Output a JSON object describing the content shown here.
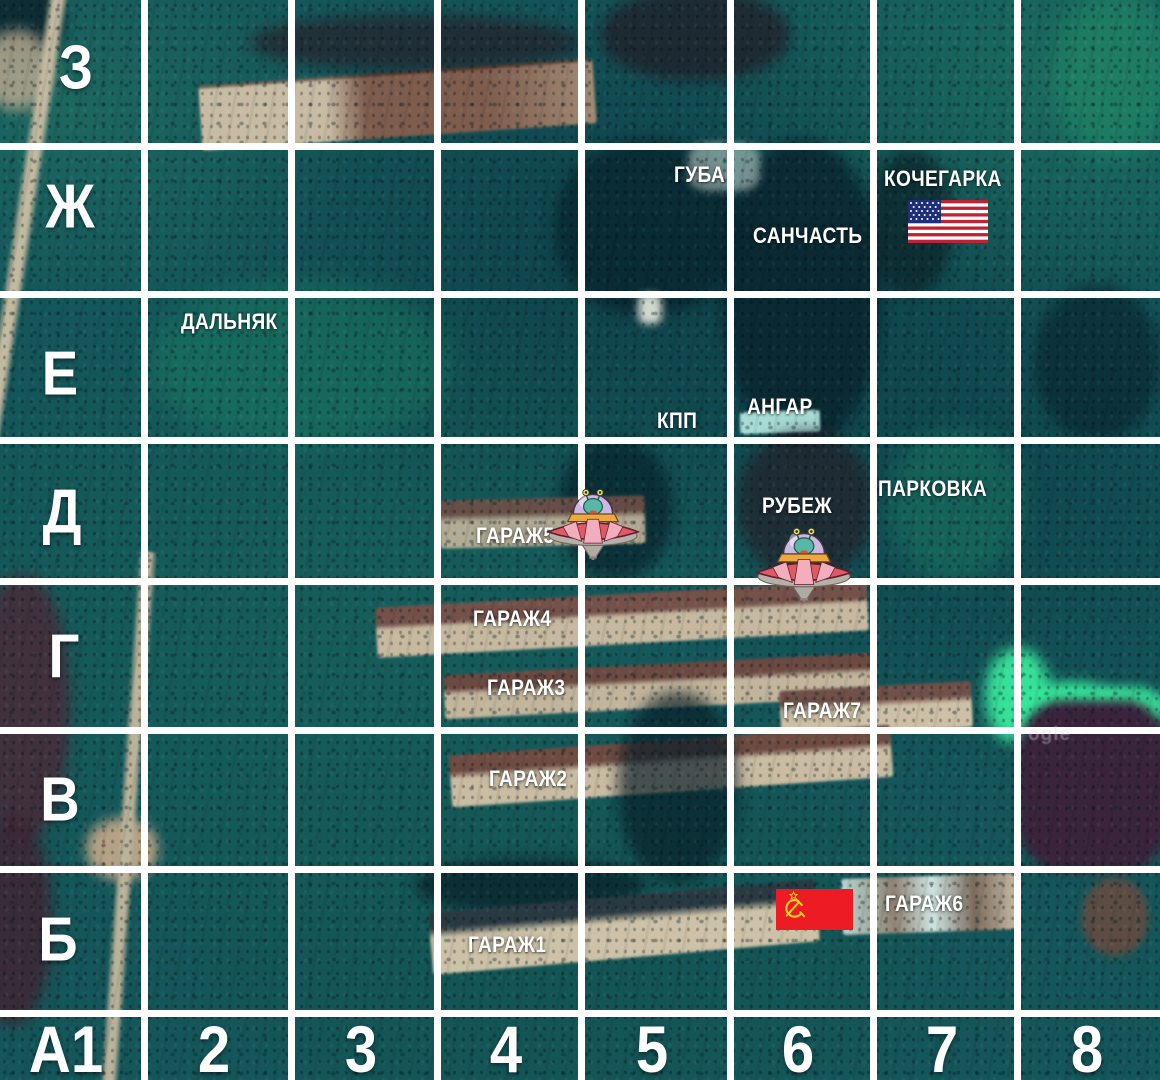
{
  "grid": {
    "rows": [
      "З",
      "Ж",
      "Е",
      "Д",
      "Г",
      "В",
      "Б"
    ],
    "corner": "А1",
    "columns": [
      "2",
      "3",
      "4",
      "5",
      "6",
      "7",
      "8"
    ]
  },
  "locations": [
    {
      "label": "ГУБА",
      "cell": "Ж5"
    },
    {
      "label": "КОЧЕГАРКА",
      "cell": "Ж7"
    },
    {
      "label": "САНЧАСТЬ",
      "cell": "Ж6"
    },
    {
      "label": "ДАЛЬНЯК",
      "cell": "Е2"
    },
    {
      "label": "КПП",
      "cell": "Е5"
    },
    {
      "label": "АНГАР",
      "cell": "Е6"
    },
    {
      "label": "ГАРАЖ5",
      "cell": "Д4"
    },
    {
      "label": "РУБЕЖ",
      "cell": "Д6"
    },
    {
      "label": "ПАРКОВКА",
      "cell": "Д7"
    },
    {
      "label": "ГАРАЖ4",
      "cell": "Г4"
    },
    {
      "label": "ГАРАЖ3",
      "cell": "Г4"
    },
    {
      "label": "ГАРАЖ7",
      "cell": "Г6"
    },
    {
      "label": "ГАРАЖ2",
      "cell": "В4"
    },
    {
      "label": "ГАРАЖ1",
      "cell": "Б4"
    },
    {
      "label": "ГАРАЖ6",
      "cell": "Б7"
    }
  ],
  "markers": [
    {
      "name": "us-flag",
      "cell": "Ж7"
    },
    {
      "name": "soviet-flag",
      "cell": "Б6"
    },
    {
      "name": "ufo",
      "cell": "Д4/Д5"
    },
    {
      "name": "ufo",
      "cell": "Д6"
    }
  ],
  "watermark": "ogle",
  "colors": {
    "grid_line": "#ffffff",
    "label_text": "#ffffff",
    "terrain_base": "#14565a",
    "neon_green": "#3cf0a0",
    "us_flag_blue": "#1e2f7a",
    "us_flag_red": "#bf2333",
    "soviet_red": "#ed1c24",
    "soviet_gold": "#f8d020"
  }
}
